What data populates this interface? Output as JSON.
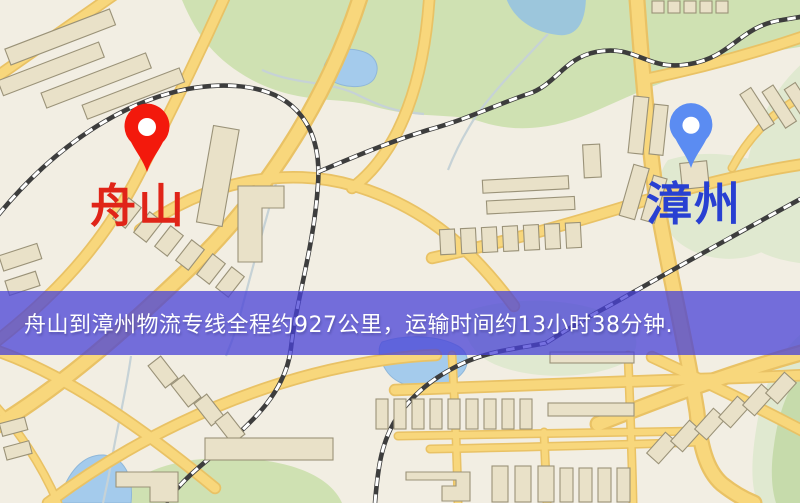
{
  "map": {
    "colors": {
      "background": "#f2eee3",
      "road": "#f8d77c",
      "road_casing": "#e9c265",
      "park": "#cfe1b2",
      "park_pale": "#e0e9d0",
      "water": "#a4cbec",
      "building": "#e9e1c8",
      "building_outline": "#9a9278",
      "railway": "#3d3d3d",
      "stream": "#c6d2d6"
    }
  },
  "pins": {
    "origin": {
      "label": "舟山",
      "pin_color": "#f3190c",
      "label_color": "#e02418"
    },
    "destination": {
      "label": "漳州",
      "pin_color": "#5b8cf2",
      "label_color": "#2840d2"
    }
  },
  "banner": {
    "text": "舟山到漳州物流专线全程约927公里，运输时间约13小时38分钟.",
    "background": "rgba(72,66,215,0.75)",
    "text_color": "#ffffff"
  },
  "route": {
    "origin": "舟山",
    "destination": "漳州",
    "distance_text": "约927公里",
    "duration_text": "约13小时38分钟"
  }
}
